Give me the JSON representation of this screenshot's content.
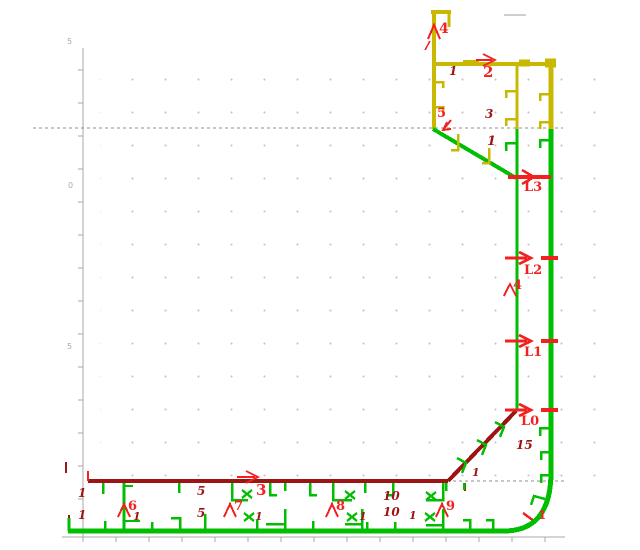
{
  "colors": {
    "g": "#00be00",
    "y": "#c9b802",
    "r": "#f32020",
    "m": "#9b1515",
    "a": "#a9a9a9",
    "d": "#8f8f8f",
    "l": "#cfcfcf"
  },
  "axis": {
    "vline": [
      83,
      48,
      83,
      537
    ],
    "hline": [
      62,
      537,
      565,
      537
    ],
    "vticks": [
      70,
      103,
      136,
      169,
      202,
      235,
      268,
      301,
      334,
      367,
      400,
      433,
      466,
      499,
      532
    ],
    "hticks": [
      83,
      116,
      149,
      182,
      215,
      248,
      281,
      314,
      347,
      380,
      413,
      446,
      479,
      512,
      545
    ]
  },
  "drawing": {
    "segments": [
      [
        504,
        15,
        526,
        15,
        2,
        "l"
      ],
      [
        434,
        10,
        434,
        129,
        4,
        "y"
      ],
      [
        431,
        12,
        451,
        12,
        4,
        "y"
      ],
      [
        449,
        12,
        449,
        27,
        3,
        "y"
      ],
      [
        434,
        64,
        553,
        64,
        4,
        "y"
      ],
      [
        463,
        63,
        479,
        63,
        6,
        "y"
      ],
      [
        519,
        63,
        530,
        63,
        7,
        "y"
      ],
      [
        545,
        63,
        556,
        63,
        9,
        "y"
      ],
      [
        517,
        66,
        517,
        129,
        3,
        "y"
      ],
      [
        551,
        66,
        551,
        129,
        5,
        "y"
      ],
      [
        433,
        129,
        516,
        178,
        4,
        "g"
      ],
      [
        517,
        129,
        517,
        411,
        3,
        "g"
      ],
      [
        551,
        129,
        551,
        474,
        5,
        "g"
      ],
      [
        68,
        531,
        506,
        531,
        5,
        "g"
      ],
      [
        124,
        483,
        124,
        530,
        3,
        "g"
      ],
      [
        124,
        486,
        133,
        486,
        2,
        "g"
      ],
      [
        124,
        521,
        140,
        521,
        2,
        "g"
      ],
      [
        88,
        481,
        448,
        481,
        4,
        "m"
      ],
      [
        448,
        481,
        516,
        411,
        4,
        "m"
      ],
      [
        465,
        483,
        465,
        491,
        2,
        "m"
      ],
      [
        66,
        462,
        66,
        473,
        2,
        "m"
      ],
      [
        69,
        515,
        69,
        522,
        2,
        "m"
      ],
      [
        88,
        471,
        88,
        481,
        2,
        "r"
      ],
      [
        237,
        477,
        255,
        477,
        2,
        "r"
      ],
      [
        476,
        60,
        492,
        60,
        2,
        "r"
      ],
      [
        508,
        177,
        551,
        177,
        4,
        "r"
      ],
      [
        505,
        258,
        527,
        258,
        3,
        "r"
      ],
      [
        541,
        258,
        558,
        258,
        4,
        "r"
      ],
      [
        505,
        341,
        527,
        341,
        3,
        "r"
      ],
      [
        541,
        341,
        558,
        341,
        4,
        "r"
      ],
      [
        505,
        410,
        527,
        410,
        3,
        "r"
      ],
      [
        541,
        410,
        558,
        410,
        4,
        "r"
      ],
      [
        523,
        513,
        534,
        521,
        2.5,
        "r"
      ],
      [
        451,
        120,
        443,
        130,
        2,
        "r"
      ]
    ],
    "dashed": [
      [
        33,
        128,
        563,
        128
      ],
      [
        447,
        481,
        565,
        481
      ]
    ],
    "curves": [
      [
        "M551,472 Q551,531 504,531",
        5,
        "g"
      ]
    ],
    "polylines": [
      [
        [
          [
            246,
            471
          ],
          [
            258,
            477
          ],
          [
            246,
            483
          ]
        ],
        2,
        "r"
      ],
      [
        [
          [
            483,
            54
          ],
          [
            495,
            60
          ],
          [
            483,
            66
          ]
        ],
        2,
        "r"
      ],
      [
        [
          [
            522,
            170
          ],
          [
            534,
            177
          ],
          [
            522,
            184
          ]
        ],
        2.5,
        "r"
      ],
      [
        [
          [
            519,
            252
          ],
          [
            531,
            258
          ],
          [
            519,
            264
          ]
        ],
        2.5,
        "r"
      ],
      [
        [
          [
            519,
            335
          ],
          [
            531,
            341
          ],
          [
            519,
            347
          ]
        ],
        2.5,
        "r"
      ],
      [
        [
          [
            519,
            404
          ],
          [
            531,
            410
          ],
          [
            519,
            416
          ]
        ],
        2.5,
        "r"
      ],
      [
        [
          [
            451,
            129
          ],
          [
            443,
            130
          ],
          [
            447,
            122
          ]
        ],
        2,
        "r"
      ],
      [
        [
          [
            428,
            39
          ],
          [
            434,
            25
          ],
          [
            440,
            39
          ]
        ],
        2,
        "r"
      ],
      [
        [
          [
            425,
            50
          ],
          [
            430,
            41
          ]
        ],
        1.5,
        "r"
      ],
      [
        [
          [
            504,
            296
          ],
          [
            510,
            284
          ],
          [
            516,
            296
          ]
        ],
        2,
        "r"
      ],
      [
        [
          [
            118,
            517
          ],
          [
            124,
            504
          ],
          [
            130,
            517
          ]
        ],
        2,
        "r"
      ],
      [
        [
          [
            224,
            517
          ],
          [
            230,
            504
          ],
          [
            236,
            517
          ]
        ],
        2,
        "r"
      ],
      [
        [
          [
            326,
            517
          ],
          [
            332,
            504
          ],
          [
            338,
            517
          ]
        ],
        2,
        "r"
      ],
      [
        [
          [
            436,
            517
          ],
          [
            442,
            504
          ],
          [
            448,
            517
          ]
        ],
        2,
        "r"
      ],
      [
        [
          [
            434,
            82
          ],
          [
            443,
            82
          ],
          [
            443,
            88
          ]
        ],
        2.5,
        "y"
      ],
      [
        [
          [
            434,
            107
          ],
          [
            443,
            107
          ],
          [
            443,
            113
          ]
        ],
        2.5,
        "y"
      ],
      [
        [
          [
            517,
            91
          ],
          [
            506,
            91
          ],
          [
            506,
            98
          ]
        ],
        2.5,
        "y"
      ],
      [
        [
          [
            517,
            119
          ],
          [
            506,
            119
          ],
          [
            506,
            126
          ]
        ],
        2.5,
        "y"
      ],
      [
        [
          [
            551,
            94
          ],
          [
            540,
            94
          ],
          [
            540,
            101
          ]
        ],
        2.5,
        "y"
      ],
      [
        [
          [
            551,
            122
          ],
          [
            540,
            122
          ],
          [
            540,
            129
          ]
        ],
        2.5,
        "y"
      ],
      [
        [
          [
            458,
            134
          ],
          [
            458,
            150
          ],
          [
            451,
            150
          ]
        ],
        2.5,
        "y"
      ],
      [
        [
          [
            489,
            148
          ],
          [
            489,
            163
          ],
          [
            482,
            163
          ]
        ],
        2.5,
        "y"
      ],
      [
        [
          [
            517,
            143
          ],
          [
            506,
            143
          ],
          [
            506,
            151
          ]
        ],
        2.5,
        "g"
      ],
      [
        [
          [
            551,
            140
          ],
          [
            540,
            140
          ],
          [
            540,
            148
          ]
        ],
        2.5,
        "g"
      ],
      [
        [
          [
            551,
            428
          ],
          [
            540,
            428
          ],
          [
            540,
            436
          ]
        ],
        2.5,
        "g"
      ],
      [
        [
          [
            551,
            452
          ],
          [
            541,
            452
          ],
          [
            541,
            460
          ]
        ],
        2.5,
        "g"
      ],
      [
        [
          [
            551,
            475
          ],
          [
            541,
            475
          ],
          [
            541,
            483
          ]
        ],
        2.5,
        "g"
      ],
      [
        [
          [
            545,
            499
          ],
          [
            534,
            496
          ],
          [
            531,
            505
          ]
        ],
        2.5,
        "g"
      ],
      [
        [
          [
            457,
            458
          ],
          [
            466,
            463
          ],
          [
            462,
            473
          ]
        ],
        2.5,
        "g"
      ],
      [
        [
          [
            477,
            440
          ],
          [
            486,
            445
          ],
          [
            482,
            455
          ]
        ],
        2.5,
        "g"
      ],
      [
        [
          [
            495,
            422
          ],
          [
            504,
            427
          ],
          [
            500,
            437
          ]
        ],
        2.5,
        "g"
      ],
      [
        [
          [
            103,
            483
          ],
          [
            103,
            494
          ]
        ],
        2.5,
        "g"
      ],
      [
        [
          [
            179,
            483
          ],
          [
            179,
            493
          ]
        ],
        2.5,
        "g"
      ],
      [
        [
          [
            270,
            483
          ],
          [
            270,
            495
          ],
          [
            277,
            495
          ]
        ],
        2.5,
        "g"
      ],
      [
        [
          [
            285,
            483
          ],
          [
            285,
            491
          ]
        ],
        2.5,
        "g"
      ],
      [
        [
          [
            310,
            483
          ],
          [
            310,
            495
          ],
          [
            317,
            495
          ]
        ],
        2.5,
        "g"
      ],
      [
        [
          [
            365,
            483
          ],
          [
            365,
            493
          ]
        ],
        2.5,
        "g"
      ],
      [
        [
          [
            393,
            483
          ],
          [
            393,
            495
          ],
          [
            386,
            495
          ]
        ],
        2.5,
        "g"
      ],
      [
        [
          [
            464,
            483
          ],
          [
            464,
            490
          ]
        ],
        2.5,
        "g"
      ],
      [
        [
          [
            446,
            483
          ],
          [
            446,
            491
          ]
        ],
        2.5,
        "g"
      ],
      [
        [
          [
            232,
            483
          ],
          [
            232,
            500
          ],
          [
            248,
            500
          ]
        ],
        2.5,
        "g"
      ],
      [
        [
          [
            333,
            483
          ],
          [
            333,
            500
          ],
          [
            352,
            500
          ]
        ],
        2.5,
        "g"
      ],
      [
        [
          [
            443,
            483
          ],
          [
            443,
            500
          ],
          [
            426,
            500
          ]
        ],
        2.5,
        "g"
      ],
      [
        [
          [
            69,
            531
          ],
          [
            69,
            518
          ]
        ],
        3,
        "g"
      ],
      [
        [
          [
            105,
            531
          ],
          [
            105,
            521
          ]
        ],
        2.5,
        "g"
      ],
      [
        [
          [
            152,
            531
          ],
          [
            152,
            522
          ]
        ],
        2.5,
        "g"
      ],
      [
        [
          [
            171,
            518
          ],
          [
            180,
            518
          ],
          [
            180,
            531
          ]
        ],
        2.5,
        "g"
      ],
      [
        [
          [
            205,
            531
          ],
          [
            205,
            514
          ]
        ],
        2.5,
        "g"
      ],
      [
        [
          [
            257,
            531
          ],
          [
            257,
            520
          ]
        ],
        2.5,
        "g"
      ],
      [
        [
          [
            313,
            531
          ],
          [
            313,
            521
          ]
        ],
        2.5,
        "g"
      ],
      [
        [
          [
            367,
            531
          ],
          [
            367,
            522
          ]
        ],
        2.5,
        "g"
      ],
      [
        [
          [
            395,
            531
          ],
          [
            395,
            522
          ]
        ],
        2.5,
        "g"
      ],
      [
        [
          [
            463,
            520
          ],
          [
            470,
            520
          ],
          [
            470,
            531
          ]
        ],
        2.5,
        "g"
      ],
      [
        [
          [
            486,
            520
          ],
          [
            493,
            520
          ],
          [
            493,
            531
          ]
        ],
        2.5,
        "g"
      ],
      [
        [
          [
            266,
            524
          ],
          [
            285,
            524
          ]
        ],
        2.5,
        "g"
      ],
      [
        [
          [
            285,
            509
          ],
          [
            285,
            531
          ]
        ],
        2.5,
        "g"
      ],
      [
        [
          [
            345,
            524
          ],
          [
            362,
            524
          ]
        ],
        2.5,
        "g"
      ],
      [
        [
          [
            362,
            509
          ],
          [
            362,
            531
          ]
        ],
        2.5,
        "g"
      ],
      [
        [
          [
            426,
            525
          ],
          [
            443,
            525
          ]
        ],
        2.5,
        "g"
      ],
      [
        [
          [
            443,
            509
          ],
          [
            443,
            531
          ]
        ],
        2.5,
        "g"
      ]
    ],
    "xmarks": [
      [
        247,
        494
      ],
      [
        249,
        517
      ],
      [
        350,
        495
      ],
      [
        352,
        517
      ],
      [
        431,
        496
      ],
      [
        430,
        517
      ]
    ],
    "labels": [
      [
        439,
        22,
        "4",
        "r",
        14
      ],
      [
        483,
        65,
        "2",
        "r",
        15
      ],
      [
        437,
        107,
        "5",
        "r",
        13
      ],
      [
        524,
        181,
        "L3",
        "r",
        13
      ],
      [
        524,
        264,
        "L2",
        "r",
        13
      ],
      [
        524,
        346,
        "L1",
        "r",
        13
      ],
      [
        521,
        415,
        "L0",
        "r",
        13
      ],
      [
        513,
        279,
        "4",
        "r",
        13
      ],
      [
        256,
        483,
        "3",
        "r",
        15
      ],
      [
        128,
        500,
        "6",
        "r",
        13
      ],
      [
        234,
        500,
        "7",
        "r",
        13
      ],
      [
        336,
        500,
        "8",
        "r",
        13
      ],
      [
        446,
        500,
        "9",
        "r",
        13
      ],
      [
        538,
        509,
        "1",
        "r",
        12
      ],
      [
        449,
        65,
        "1",
        "m",
        12
      ],
      [
        485,
        108,
        "3",
        "m",
        12
      ],
      [
        487,
        135,
        "1",
        "m",
        13
      ],
      [
        78,
        487,
        "1",
        "m",
        12
      ],
      [
        78,
        509,
        "1",
        "m",
        12
      ],
      [
        197,
        485,
        "5",
        "m",
        12
      ],
      [
        197,
        507,
        "5",
        "m",
        12
      ],
      [
        133,
        511,
        "1",
        "m",
        11
      ],
      [
        255,
        511,
        "1",
        "m",
        11
      ],
      [
        359,
        511,
        "1",
        "m",
        11
      ],
      [
        409,
        510,
        "1",
        "m",
        11
      ],
      [
        383,
        490,
        "10",
        "m",
        12
      ],
      [
        383,
        506,
        "10",
        "m",
        12
      ],
      [
        472,
        467,
        "1",
        "m",
        11
      ],
      [
        516,
        439,
        "15",
        "m",
        12
      ],
      [
        67,
        38,
        "5",
        "a",
        8
      ],
      [
        68,
        182,
        "0",
        "a",
        8
      ],
      [
        67,
        343,
        "5",
        "a",
        8
      ]
    ]
  }
}
